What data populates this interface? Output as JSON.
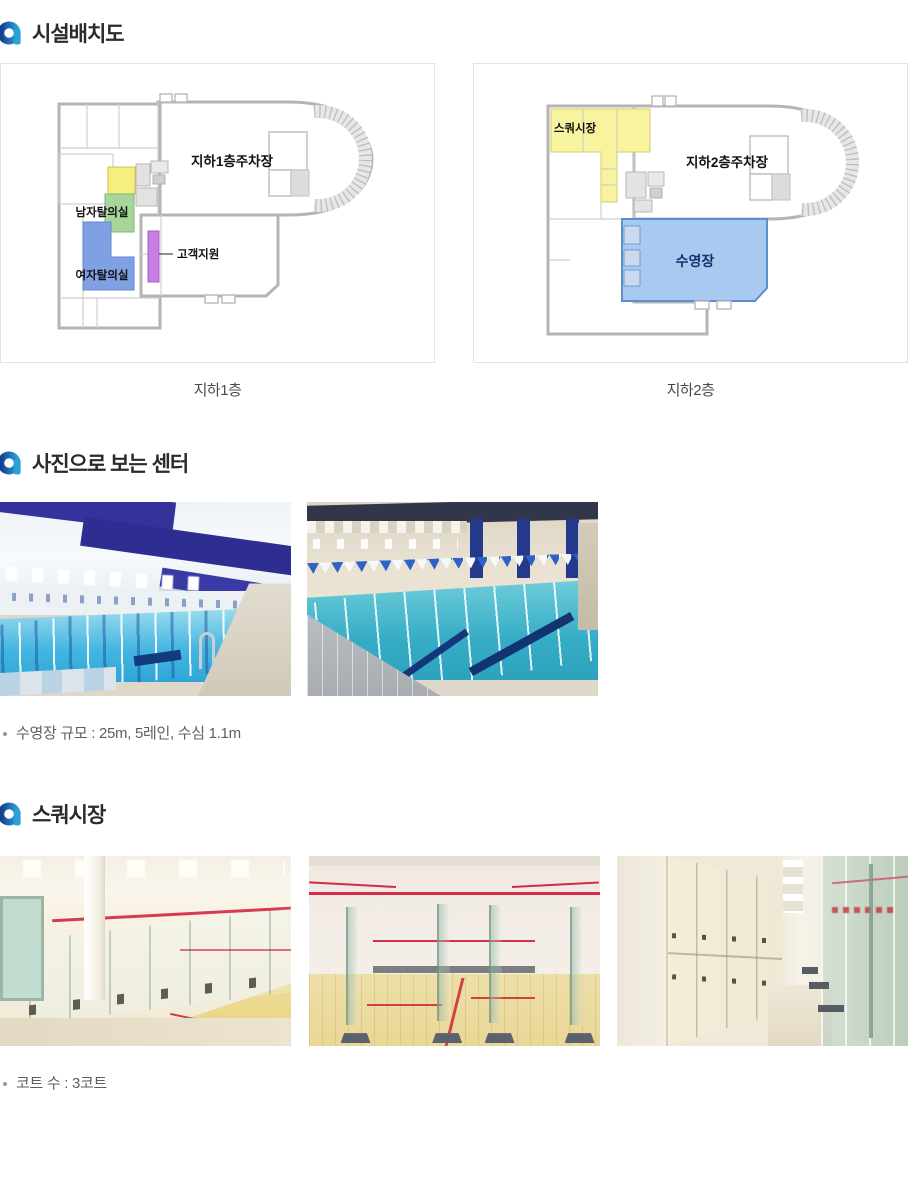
{
  "header_icon": {
    "name": "a-ring-icon",
    "color_start": "#163c8f",
    "color_end": "#2aa0d8"
  },
  "section_facility": {
    "title": "시설배치도"
  },
  "floor_plans": [
    {
      "caption": "지하1층",
      "labels": {
        "parking": "지하1층주차장",
        "mens_locker": "남자탈의실",
        "womens_locker": "여자탈의실",
        "customer_support": "고객지원"
      },
      "colors": {
        "highlight": "#f6ef7f",
        "mens_locker": "#a7d59a",
        "womens_locker": "#7fa1e4",
        "customer_support": "#c77fe6"
      }
    },
    {
      "caption": "지하2층",
      "labels": {
        "squash": "스쿼시장",
        "parking": "지하2층주차장",
        "pool": "수영장"
      },
      "colors": {
        "squash": "#f8f39f",
        "pool": "#a9c9f0"
      }
    }
  ],
  "section_photos": {
    "title": "사진으로 보는 센터",
    "note": "수영장 규모 : 25m, 5레인, 수심 1.1m"
  },
  "section_squash": {
    "title": "스쿼시장",
    "note": "코트 수 : 3코트"
  }
}
